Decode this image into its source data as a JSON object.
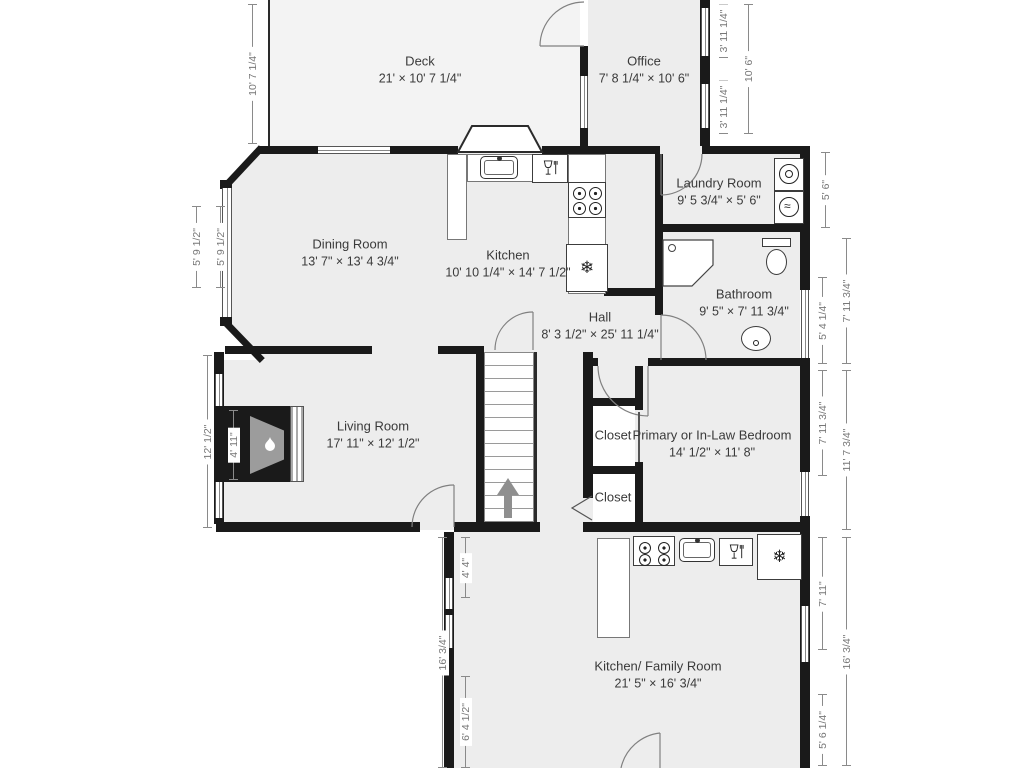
{
  "plan_title": "First floor plan",
  "colors": {
    "wall": "#1a1a1a",
    "room_fill": "#ededed",
    "deck_fill": "#f3f3f3",
    "dim": "#8a8a8a",
    "label": "#3a3a3a"
  },
  "rooms": [
    {
      "name": "Deck",
      "dims": "21' × 10' 7 1/4\"",
      "x": 420,
      "y": 70
    },
    {
      "name": "Office",
      "dims": "7' 8 1/4\" × 10' 6\"",
      "x": 644,
      "y": 70
    },
    {
      "name": "Laundry Room",
      "dims": "9' 5 3/4\" × 5' 6\"",
      "x": 719,
      "y": 192
    },
    {
      "name": "Dining Room",
      "dims": "13' 7\" × 13' 4 3/4\"",
      "x": 350,
      "y": 253
    },
    {
      "name": "Kitchen",
      "dims": "10' 10 1/4\" × 14' 7 1/2\"",
      "x": 508,
      "y": 264
    },
    {
      "name": "Bathroom",
      "dims": "9' 5\" × 7' 11 3/4\"",
      "x": 744,
      "y": 303
    },
    {
      "name": "Hall",
      "dims": "8' 3 1/2\" × 25' 11 1/4\"",
      "x": 600,
      "y": 326
    },
    {
      "name": "Living Room",
      "dims": "17' 11\" × 12' 1/2\"",
      "x": 373,
      "y": 435
    },
    {
      "name": "Closet",
      "dims": "",
      "x": 613,
      "y": 436
    },
    {
      "name": "Closet",
      "dims": "",
      "x": 613,
      "y": 498
    },
    {
      "name": "Primary or In-Law Bedroom",
      "dims": "14' 1/2\" × 11' 8\"",
      "x": 712,
      "y": 444
    },
    {
      "name": "Kitchen/ Family Room",
      "dims": "21' 5\" × 16' 3/4\"",
      "x": 658,
      "y": 675
    }
  ],
  "dimensions": [
    {
      "text": "10' 7 1/4\"",
      "x": 252,
      "y1": 4,
      "y2": 144
    },
    {
      "text": "5' 9 1/2\"",
      "x": 196,
      "y1": 206,
      "y2": 288
    },
    {
      "text": "5' 9 1/2\"",
      "x": 220,
      "y1": 206,
      "y2": 288
    },
    {
      "text": "12' 1/2\"",
      "x": 207,
      "y1": 355,
      "y2": 528
    },
    {
      "text": "4' 11\"",
      "x": 233,
      "y1": 410,
      "y2": 480
    },
    {
      "text": "16' 3/4\"",
      "x": 442,
      "y1": 537,
      "y2": 768
    },
    {
      "text": "4' 4\"",
      "x": 465,
      "y1": 537,
      "y2": 598
    },
    {
      "text": "6' 4 1/2\"",
      "x": 465,
      "y1": 676,
      "y2": 768
    },
    {
      "text": "3' 11 1/4\"",
      "x": 723,
      "y1": 4,
      "y2": 58
    },
    {
      "text": "3' 11 1/4\"",
      "x": 723,
      "y1": 80,
      "y2": 134
    },
    {
      "text": "10' 6\"",
      "x": 748,
      "y1": 4,
      "y2": 134
    },
    {
      "text": "5' 6\"",
      "x": 825,
      "y1": 152,
      "y2": 228
    },
    {
      "text": "5' 4 1/4\"",
      "x": 822,
      "y1": 277,
      "y2": 364
    },
    {
      "text": "7' 11 3/4\"",
      "x": 846,
      "y1": 238,
      "y2": 364
    },
    {
      "text": "7' 11 3/4\"",
      "x": 822,
      "y1": 370,
      "y2": 476
    },
    {
      "text": "11' 7 3/4\"",
      "x": 846,
      "y1": 370,
      "y2": 530
    },
    {
      "text": "7' 11\"",
      "x": 822,
      "y1": 537,
      "y2": 650
    },
    {
      "text": "16' 3/4\"",
      "x": 846,
      "y1": 537,
      "y2": 766
    },
    {
      "text": "5' 6 1/4\"",
      "x": 822,
      "y1": 694,
      "y2": 766
    }
  ],
  "icons": {
    "refrigerator": "❄",
    "dryer": "≈"
  }
}
